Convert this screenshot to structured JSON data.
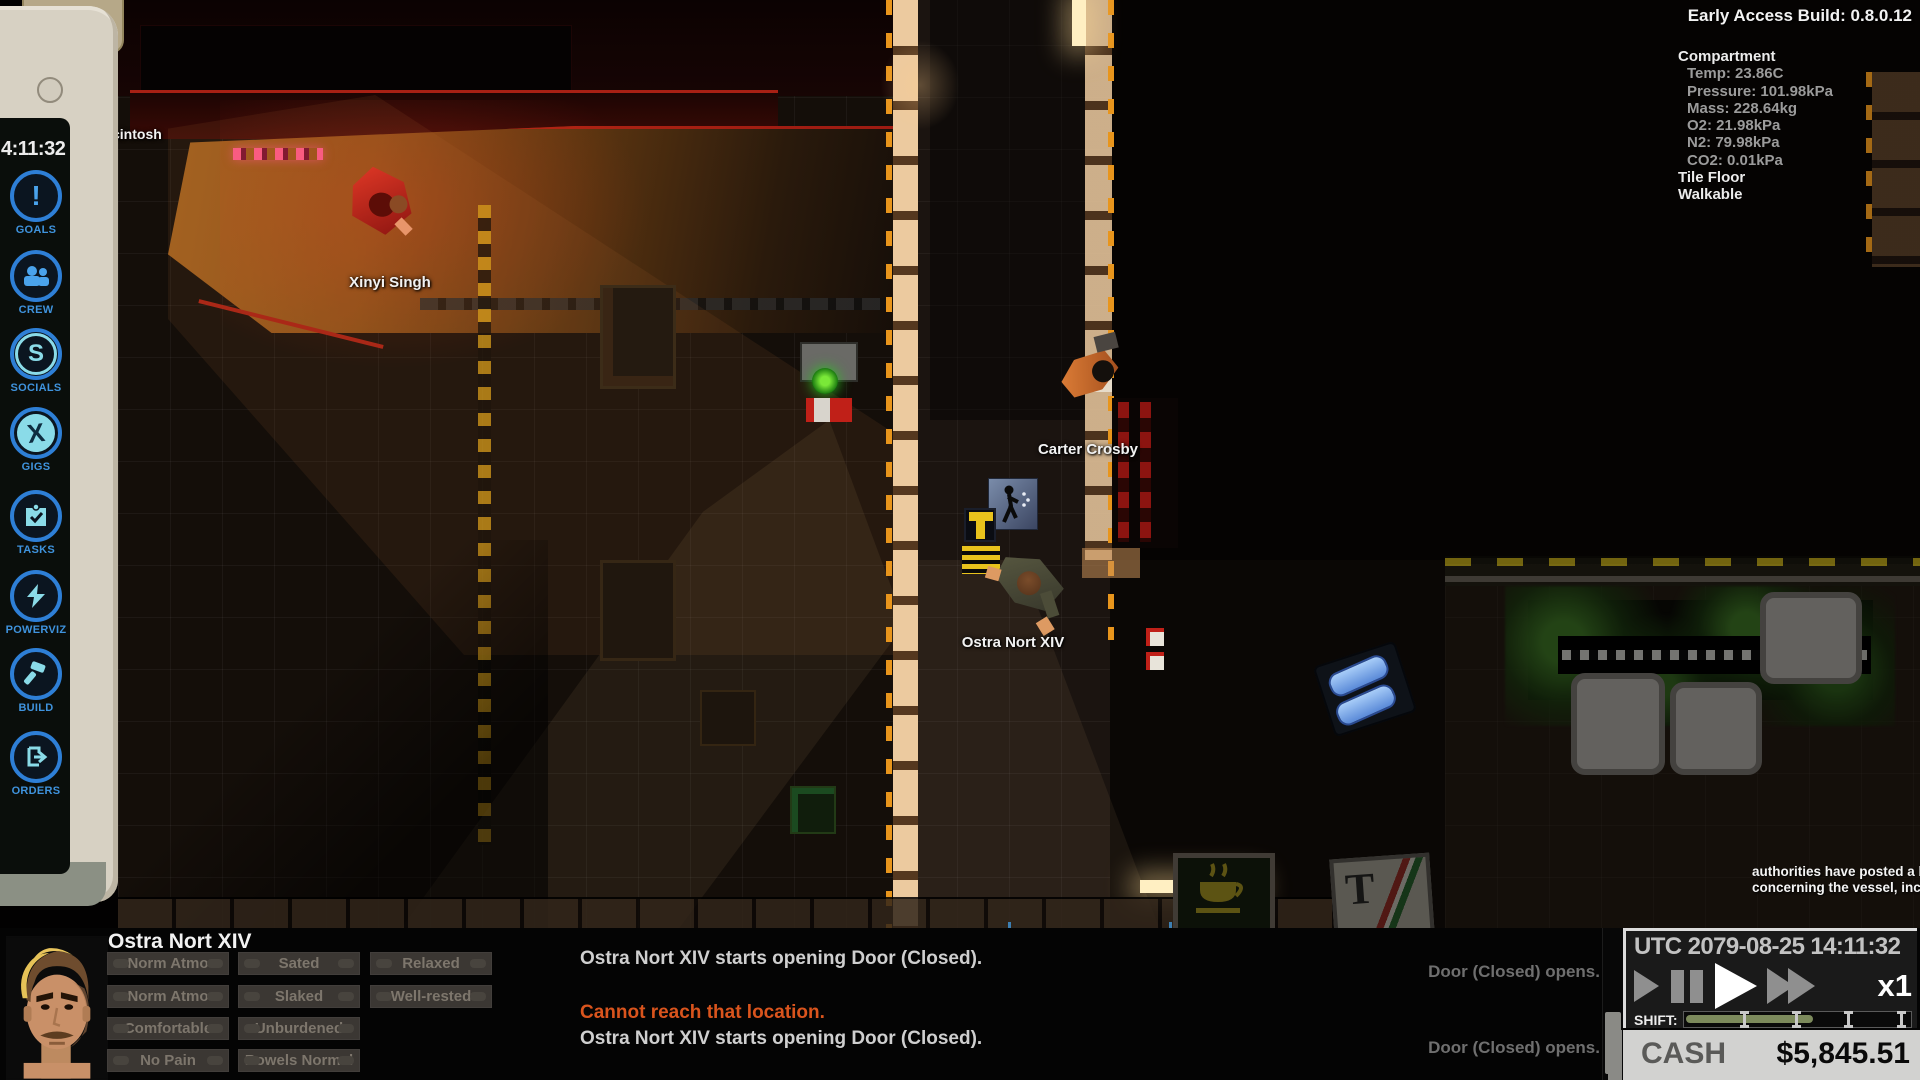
{
  "meta": {
    "build_label": "Early Access Build: 0.8.0.12"
  },
  "tile_info": {
    "title": "Compartment",
    "stats": [
      "Temp: 23.86C",
      "Pressure: 101.98kPa",
      "Mass: 228.64kg",
      "O2: 21.98kPa",
      "N2: 79.98kPa",
      "CO2: 0.01kPa"
    ],
    "tile_type": "Tile Floor",
    "tile_flag": "Walkable"
  },
  "sidebar": {
    "clock": "4:11:32",
    "items": [
      {
        "id": "goals",
        "label": "GOALS"
      },
      {
        "id": "crew",
        "label": "CREW"
      },
      {
        "id": "socials",
        "label": "SOCIALS"
      },
      {
        "id": "gigs",
        "label": "GIGS"
      },
      {
        "id": "tasks",
        "label": "TASKS"
      },
      {
        "id": "powerviz",
        "label": "POWERVIZ"
      },
      {
        "id": "build",
        "label": "BUILD"
      },
      {
        "id": "orders",
        "label": "ORDERS"
      }
    ]
  },
  "map": {
    "ship_label": "cintosh",
    "characters": [
      {
        "name": "Xinyi Singh"
      },
      {
        "name": "Carter Crosby"
      },
      {
        "name": "Ostra Nort XIV"
      }
    ],
    "notification_lines": [
      "authorities have posted a bo",
      "concerning the vessel, inclu"
    ]
  },
  "hud": {
    "character_name": "Ostra Nort XIV",
    "status_rows": [
      [
        "Norm Atmo",
        "Sated",
        "Relaxed"
      ],
      [
        "Norm Atmo",
        "Slaked",
        "Well-rested"
      ],
      [
        "Comfortable",
        "Unburdened"
      ],
      [
        "No Pain",
        "Bowels Normal"
      ]
    ],
    "log_center": [
      {
        "text": "Ostra Nort XIV starts opening Door (Closed)."
      },
      {
        "text": "Cannot reach that location."
      },
      {
        "text": "Ostra Nort XIV starts opening Door (Closed)."
      }
    ],
    "log_right": [
      "Door (Closed) opens.",
      "Door (Closed) opens."
    ],
    "time_panel": {
      "utc": "UTC 2079-08-25 14:11:32",
      "speed": "x1",
      "shift_label": "SHIFT:"
    },
    "cash_label": "CASH",
    "cash_amount": "$5,845.51"
  },
  "colors": {
    "accent_blue": "#3f93dd",
    "icon_cyan": "#8adbe8",
    "warning_orange": "#d9541d",
    "shift_fill": "#7c8a5c",
    "hazard_yellow": "#d8a018"
  }
}
